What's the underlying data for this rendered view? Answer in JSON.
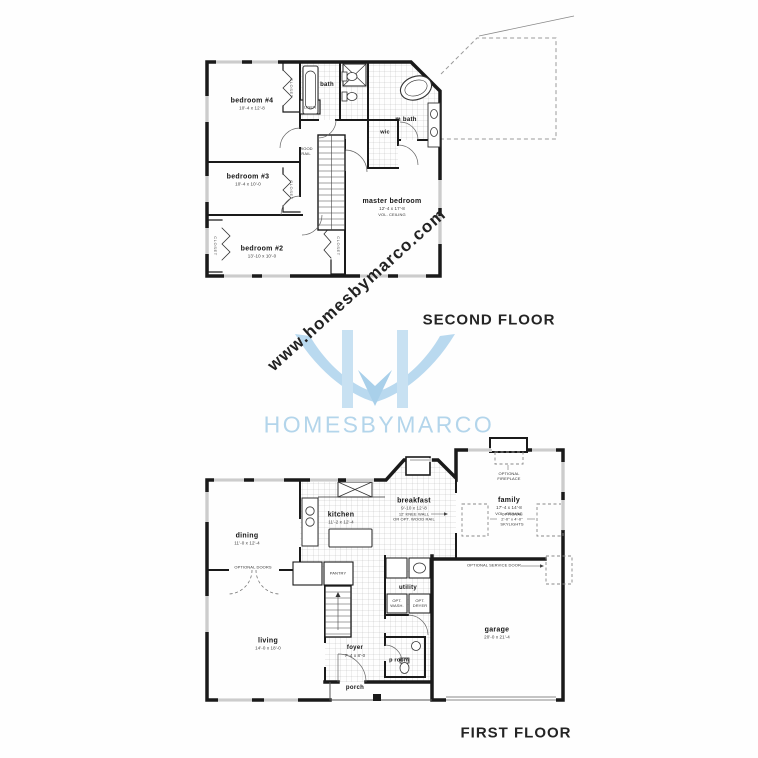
{
  "watermark": {
    "text": "www.homesbymarco.com"
  },
  "logo": {
    "monogram": "H",
    "wordmark": "HOMESBYMARCO",
    "accent_color": "#b3d5eb"
  },
  "second_floor": {
    "title": "SECOND FLOOR",
    "rooms": {
      "bedroom4": {
        "name": "bedroom #4",
        "dims": "10'-4 x 12'-8"
      },
      "bedroom3": {
        "name": "bedroom #3",
        "dims": "10'-4 x 10'-0"
      },
      "bedroom2": {
        "name": "bedroom #2",
        "dims": "13'-10 x 10'-0"
      },
      "master_bedroom": {
        "name": "master bedroom",
        "dims": "12'-4 x 17'-8",
        "note": "VOL. CEILING"
      },
      "bath": {
        "name": "bath"
      },
      "master_bath": {
        "name": "m bath"
      },
      "wic": {
        "name": "wic"
      }
    },
    "labels": {
      "closet": "CLOSET",
      "linen": "LINEN",
      "wood_rail_1": "WOOD",
      "wood_rail_2": "RAIL"
    }
  },
  "first_floor": {
    "title": "FIRST FLOOR",
    "rooms": {
      "dining": {
        "name": "dining",
        "dims": "11'-0 x 12'-4"
      },
      "kitchen": {
        "name": "kitchen",
        "dims": "11'-2 x 12'-4"
      },
      "breakfast": {
        "name": "breakfast",
        "dims": "9'-10 x 12'-8",
        "note1": "12' KNEE WALL",
        "note2": "OR OPT. WOOD RAIL"
      },
      "family": {
        "name": "family",
        "dims": "17'-4 x 14'-8",
        "note": "VOL. CEILING"
      },
      "living": {
        "name": "living",
        "dims": "14'-0 x 18'-0"
      },
      "foyer": {
        "name": "foyer",
        "dims": "7'-4 x 8'-0"
      },
      "utility": {
        "name": "utility"
      },
      "powder_room": {
        "name": "p room"
      },
      "garage": {
        "name": "garage",
        "dims": "20'-0 x 21'-4"
      },
      "porch": {
        "name": "porch"
      }
    },
    "labels": {
      "pantry": "PANTRY",
      "optional_doors": "OPTIONAL DOORS",
      "optional_fireplace_1": "OPTIONAL",
      "optional_fireplace_2": "FIREPLACE",
      "optional_skylights_1": "OPTIONAL",
      "optional_skylights_2": "2'-0\" x 4'-0\"",
      "optional_skylights_3": "SKYLIGHTS",
      "optional_service_door": "OPTIONAL SERVICE DOOR",
      "opt_washer_1": "OPT.",
      "opt_washer_2": "WASH.",
      "opt_dryer_1": "OPT.",
      "opt_dryer_2": "DRYER"
    }
  }
}
